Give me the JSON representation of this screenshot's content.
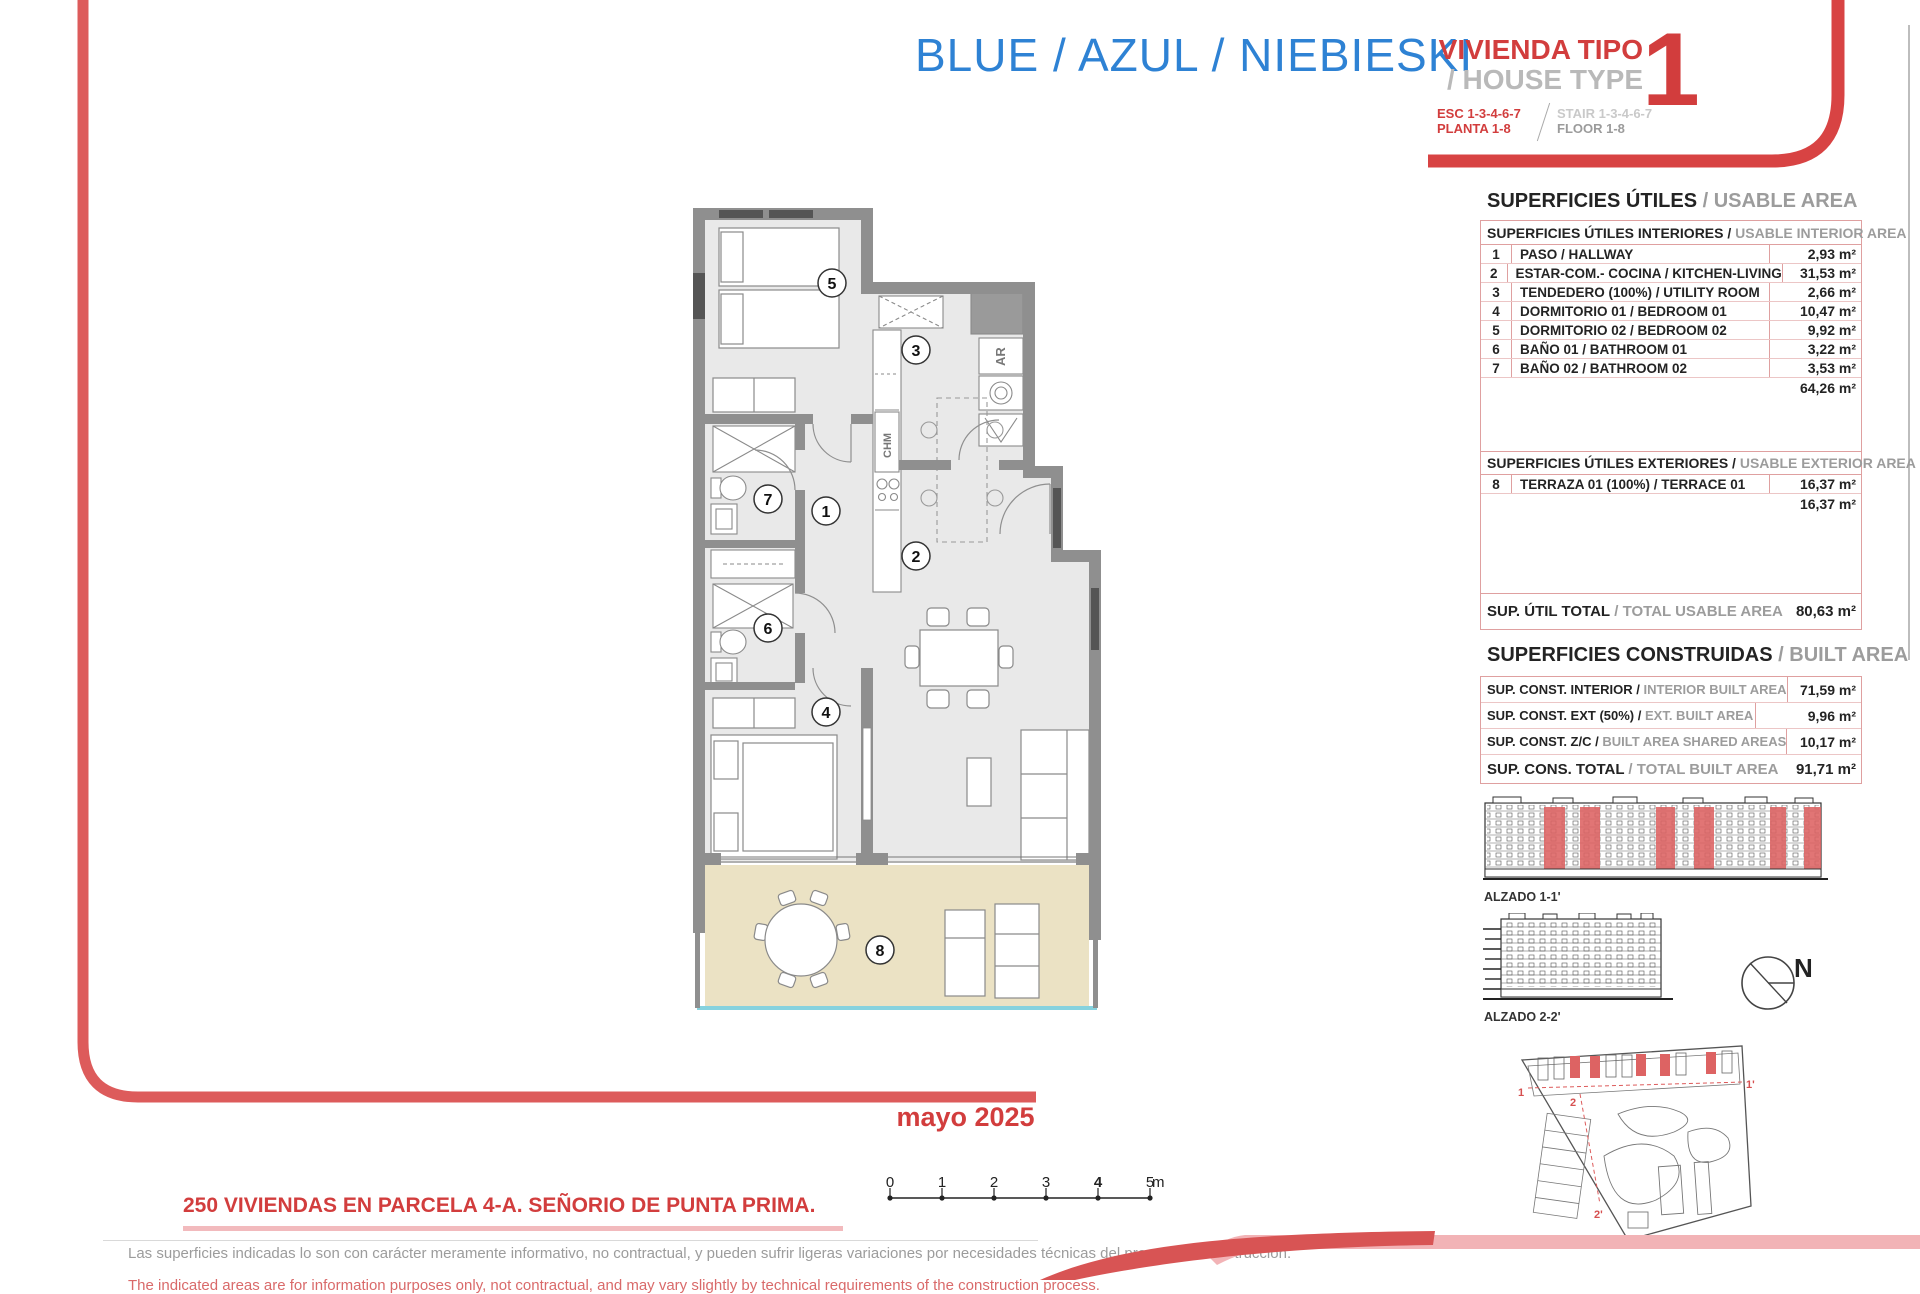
{
  "header": {
    "project_title": "BLUE / AZUL / NIEBIESKI",
    "house_type_es": "VIVIENDA TIPO",
    "house_type_en": "/ HOUSE TYPE",
    "house_type_number": "1",
    "esc_line": "ESC 1-3-4-6-7",
    "planta_line": "PLANTA 1-8",
    "stair_line": "STAIR 1-3-4-6-7",
    "floor_line": "FLOOR 1-8"
  },
  "usable_area": {
    "title_es": "SUPERFICIES ÚTILES",
    "title_en": "/ USABLE AREA",
    "interior": {
      "header_es": "SUPERFICIES ÚTILES INTERIORES /",
      "header_en": "USABLE INTERIOR AREA",
      "rows": [
        {
          "num": "1",
          "label": "PASO / HALLWAY",
          "value": "2,93 m²"
        },
        {
          "num": "2",
          "label": "ESTAR-COM.- COCINA / KITCHEN-LIVING",
          "value": "31,53 m²"
        },
        {
          "num": "3",
          "label": "TENDEDERO (100%) / UTILITY ROOM",
          "value": "2,66 m²"
        },
        {
          "num": "4",
          "label": "DORMITORIO 01 / BEDROOM 01",
          "value": "10,47 m²"
        },
        {
          "num": "5",
          "label": "DORMITORIO 02 / BEDROOM 02",
          "value": "9,92 m²"
        },
        {
          "num": "6",
          "label": "BAÑO 01 / BATHROOM 01",
          "value": "3,22 m²"
        },
        {
          "num": "7",
          "label": "BAÑO 02 / BATHROOM 02",
          "value": "3,53 m²"
        }
      ],
      "subtotal": "64,26 m²"
    },
    "exterior": {
      "header_es": "SUPERFICIES ÚTILES EXTERIORES /",
      "header_en": "USABLE EXTERIOR AREA",
      "rows": [
        {
          "num": "8",
          "label": "TERRAZA 01 (100%) / TERRACE 01",
          "value": "16,37 m²"
        }
      ],
      "subtotal": "16,37 m²"
    },
    "total_label_es": "SUP. ÚTIL TOTAL",
    "total_label_en": "/ TOTAL USABLE AREA",
    "total_value": "80,63 m²"
  },
  "built_area": {
    "title_es": "SUPERFICIES CONSTRUIDAS",
    "title_en": "/ BUILT AREA",
    "rows": [
      {
        "label_es": "SUP. CONST. INTERIOR /",
        "label_en": "INTERIOR BUILT AREA",
        "value": "71,59 m²"
      },
      {
        "label_es": "SUP. CONST. EXT (50%) /",
        "label_en": "EXT. BUILT AREA",
        "value": "9,96 m²"
      },
      {
        "label_es": "SUP. CONST. Z/C /",
        "label_en": "BUILT AREA SHARED AREAS",
        "value": "10,17 m²"
      }
    ],
    "total_label_es": "SUP. CONS. TOTAL",
    "total_label_en": "/ TOTAL BUILT AREA",
    "total_value": "91,71 m²"
  },
  "plan": {
    "room_numbers": [
      "1",
      "2",
      "3",
      "4",
      "5",
      "6",
      "7",
      "8"
    ],
    "ar_label": "AR",
    "chm_label": "CHM"
  },
  "elevations": {
    "alzado1_label": "ALZADO 1-1'",
    "alzado2_label": "ALZADO 2-2'",
    "north_label": "N",
    "site_markers": [
      "1",
      "1'",
      "2",
      "2'"
    ]
  },
  "footer": {
    "date": "mayo 2025",
    "project_line": "250 VIVIENDAS EN PARCELA 4-A. SEÑORIO DE PUNTA PRIMA.",
    "disclaimer_es": "Las superficies indicadas lo son con carácter meramente informativo, no contractual, y pueden sufrir ligeras variaciones por necesidades técnicas del proceso de construcción.",
    "disclaimer_en": "The indicated areas are for information purposes only, not contractual, and may vary slightly by technical requirements of the construction process.",
    "scale_ticks": [
      "0",
      "1",
      "2",
      "3",
      "4",
      "5"
    ],
    "scale_unit": "m"
  },
  "colors": {
    "accent_red": "#d23d3d",
    "accent_blue": "#2e82d4",
    "table_border_pink": "#dfa0a0",
    "terrace_beige": "#ebe2c4",
    "wall_gray": "#8f8f8f",
    "highlight_red": "#dd6363"
  }
}
